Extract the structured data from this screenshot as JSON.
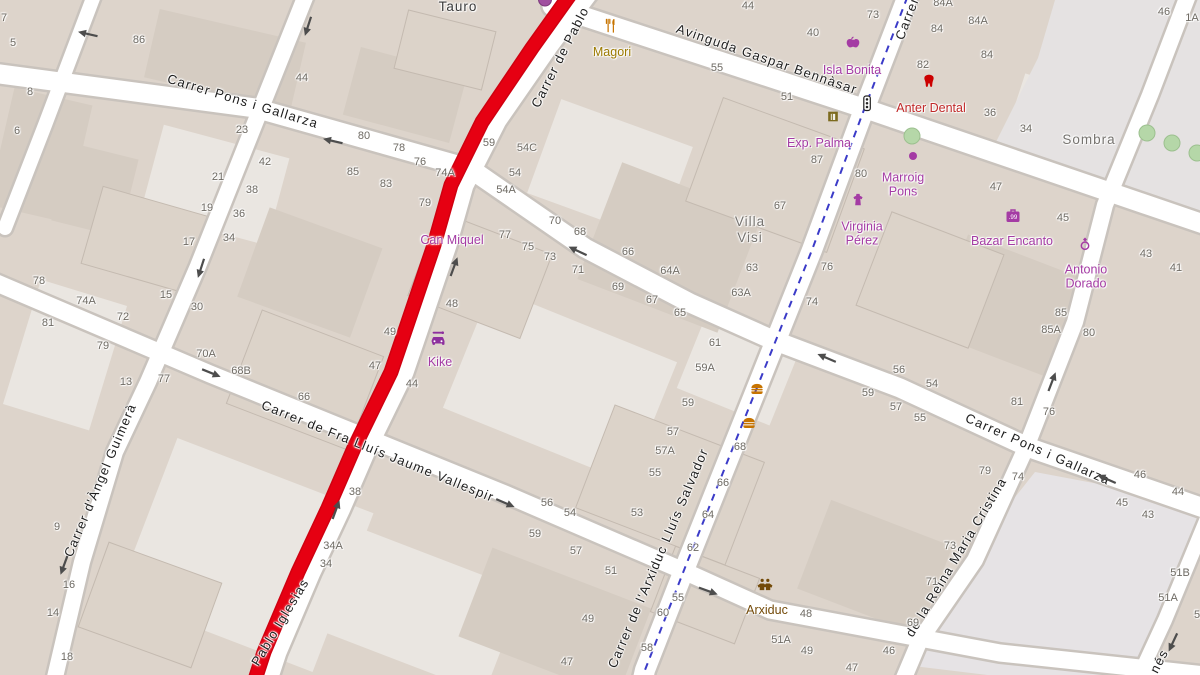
{
  "map": {
    "colors": {
      "building": "#ddd4cb",
      "street_fill": "#ffffff",
      "street_casing": "#c9c3bd",
      "route_red": "#e60012",
      "cycleway_blue": "#3b3bc8",
      "shop_magenta": "#a43ba4",
      "food_amber": "#9c7a00",
      "health_red": "#c02828",
      "community_brown": "#734a08",
      "number_gray": "#6e6a63",
      "plaza_gray": "#e5e2e2"
    },
    "street_labels": [
      {
        "text": "Carrer Pons i Gallarza",
        "x": 243,
        "y": 101,
        "rot": 17
      },
      {
        "text": "Carrer Pons i Gallarza",
        "x": 1038,
        "y": 449,
        "rot": 24
      },
      {
        "text": "Avinguda Gaspar Bennàsar",
        "x": 767,
        "y": 59,
        "rot": 19
      },
      {
        "text": "Carrer de Pablo",
        "x": 560,
        "y": 57,
        "rot": -63
      },
      {
        "text": "Pablo Iglesias",
        "x": 280,
        "y": 622,
        "rot": -59
      },
      {
        "text": "Carrer d'Àngel Guimerà",
        "x": 100,
        "y": 480,
        "rot": -67
      },
      {
        "text": "Carrer de Fra Lluís Jaume Vallespir",
        "x": 378,
        "y": 451,
        "rot": 22
      },
      {
        "text": "Carrer de l'Arxiduc Lluís Salvador",
        "x": 658,
        "y": 558,
        "rot": -67
      },
      {
        "text": "de la Reina Maria Cristina",
        "x": 956,
        "y": 557,
        "rot": -59
      },
      {
        "text": "Carrer de",
        "x": 911,
        "y": 8,
        "rot": -69
      },
      {
        "text": "nés",
        "x": 1159,
        "y": 661,
        "rot": -63
      }
    ],
    "place_labels": [
      {
        "lines": [
          "Tauro"
        ],
        "x": 458,
        "y": 7,
        "color": "#3a3a3a"
      },
      {
        "lines": [
          "Villa",
          "Visi"
        ],
        "x": 750,
        "y": 230,
        "color": "#76736f"
      },
      {
        "lines": [
          "Sombra"
        ],
        "x": 1089,
        "y": 140,
        "color": "#76736f"
      }
    ],
    "pois": [
      {
        "lines": [
          "Magori"
        ],
        "icon": "restaurant-icon",
        "ix": 610,
        "iy": 28,
        "lx": 612,
        "ly": 52,
        "color": "#9c7a00"
      },
      {
        "lines": [
          "Isla Bonita"
        ],
        "icon": "greengrocer-icon",
        "ix": 853,
        "iy": 45,
        "lx": 852,
        "ly": 70,
        "color": "#a43ba4"
      },
      {
        "lines": [
          "Anter Dental"
        ],
        "icon": "tooth-icon",
        "ix": 929,
        "iy": 84,
        "lx": 931,
        "ly": 108,
        "color": "#c02828"
      },
      {
        "lines": [
          "Exp. Palma"
        ],
        "icon": "gallery-icon",
        "ix": 833,
        "iy": 119,
        "lx": 819,
        "ly": 143,
        "color": "#a43ba4"
      },
      {
        "lines": [
          "Marroig",
          "Pons"
        ],
        "icon": "shop-dot-icon",
        "ix": 913,
        "iy": 157,
        "lx": 903,
        "ly": 185,
        "color": "#a43ba4"
      },
      {
        "lines": [
          "Virginia",
          "Pérez"
        ],
        "icon": "clothes-icon",
        "ix": 858,
        "iy": 202,
        "lx": 862,
        "ly": 234,
        "color": "#a43ba4"
      },
      {
        "lines": [
          "Bazar Encanto"
        ],
        "icon": "variety-store-icon",
        "ix": 1013,
        "iy": 218,
        "lx": 1012,
        "ly": 241,
        "color": "#a43ba4"
      },
      {
        "lines": [
          "Antonio",
          "Dorado"
        ],
        "icon": "jewelry-ring-icon",
        "ix": 1085,
        "iy": 246,
        "lx": 1086,
        "ly": 277,
        "color": "#a43ba4"
      },
      {
        "lines": [
          "Can Miquel"
        ],
        "icon": null,
        "lx": 452,
        "ly": 240,
        "color": "#a43ba4"
      },
      {
        "lines": [
          "Kike"
        ],
        "icon": "car-repair-icon",
        "ix": 438,
        "iy": 340,
        "lx": 440,
        "ly": 362,
        "color": "#a43ba4"
      },
      {
        "lines": [],
        "icon": "fast-food-icon",
        "ix": 757,
        "iy": 391,
        "color": "#c77400"
      },
      {
        "lines": [],
        "icon": "fast-food-icon",
        "ix": 749,
        "iy": 425,
        "color": "#c77400"
      },
      {
        "lines": [
          "Arxiduc"
        ],
        "icon": "community-icon",
        "ix": 765,
        "iy": 587,
        "lx": 767,
        "ly": 610,
        "color": "#734a08"
      },
      {
        "lines": [],
        "icon": "traffic-signals-icon",
        "ix": 867,
        "iy": 106,
        "color": "#222222"
      },
      {
        "lines": [],
        "icon": "shop-circle-icon",
        "ix": 545,
        "iy": 2,
        "color": "#a04fa0"
      }
    ],
    "house_numbers": [
      [
        "86",
        139,
        40
      ],
      [
        "7",
        4,
        18
      ],
      [
        "5",
        13,
        43
      ],
      [
        "8",
        30,
        92
      ],
      [
        "6",
        17,
        131
      ],
      [
        "44",
        302,
        78
      ],
      [
        "23",
        242,
        130
      ],
      [
        "42",
        265,
        162
      ],
      [
        "21",
        218,
        177
      ],
      [
        "38",
        252,
        190
      ],
      [
        "80",
        364,
        136
      ],
      [
        "85",
        353,
        172
      ],
      [
        "83",
        386,
        184
      ],
      [
        "78",
        399,
        148
      ],
      [
        "76",
        420,
        162
      ],
      [
        "74A",
        445,
        173
      ],
      [
        "59",
        489,
        143
      ],
      [
        "54C",
        527,
        148
      ],
      [
        "54",
        515,
        173
      ],
      [
        "54A",
        506,
        190
      ],
      [
        "44",
        748,
        6
      ],
      [
        "55",
        717,
        68
      ],
      [
        "51",
        787,
        97
      ],
      [
        "73",
        873,
        15
      ],
      [
        "40",
        813,
        33
      ],
      [
        "84A",
        943,
        3
      ],
      [
        "84A",
        978,
        21
      ],
      [
        "84",
        937,
        29
      ],
      [
        "84",
        987,
        55
      ],
      [
        "82",
        923,
        65
      ],
      [
        "36",
        990,
        113
      ],
      [
        "34",
        1026,
        129
      ],
      [
        "47",
        996,
        187
      ],
      [
        "87",
        817,
        160
      ],
      [
        "80",
        861,
        174
      ],
      [
        "46",
        1164,
        12
      ],
      [
        "1A",
        1192,
        18
      ],
      [
        "19",
        207,
        208
      ],
      [
        "36",
        239,
        214
      ],
      [
        "17",
        189,
        242
      ],
      [
        "34",
        229,
        238
      ],
      [
        "15",
        166,
        295
      ],
      [
        "30",
        197,
        307
      ],
      [
        "13",
        126,
        382
      ],
      [
        "77",
        164,
        379
      ],
      [
        "78",
        39,
        281
      ],
      [
        "74A",
        86,
        301
      ],
      [
        "72",
        123,
        317
      ],
      [
        "81",
        48,
        323
      ],
      [
        "79",
        103,
        346
      ],
      [
        "70A",
        206,
        354
      ],
      [
        "68B",
        241,
        371
      ],
      [
        "66",
        304,
        397
      ],
      [
        "79",
        425,
        203
      ],
      [
        "77",
        505,
        235
      ],
      [
        "75",
        528,
        247
      ],
      [
        "73",
        550,
        257
      ],
      [
        "71",
        578,
        270
      ],
      [
        "69",
        618,
        287
      ],
      [
        "67",
        652,
        300
      ],
      [
        "65",
        680,
        313
      ],
      [
        "70",
        555,
        221
      ],
      [
        "68",
        580,
        232
      ],
      [
        "66",
        628,
        252
      ],
      [
        "64A",
        670,
        271
      ],
      [
        "63",
        752,
        268
      ],
      [
        "63A",
        741,
        293
      ],
      [
        "67",
        780,
        206
      ],
      [
        "61",
        715,
        343
      ],
      [
        "59A",
        705,
        368
      ],
      [
        "59",
        688,
        403
      ],
      [
        "57",
        673,
        432
      ],
      [
        "48",
        452,
        304
      ],
      [
        "49",
        390,
        332
      ],
      [
        "47",
        375,
        366
      ],
      [
        "44",
        412,
        384
      ],
      [
        "38",
        355,
        492
      ],
      [
        "34A",
        333,
        546
      ],
      [
        "34",
        326,
        564
      ],
      [
        "9",
        57,
        527
      ],
      [
        "16",
        69,
        585
      ],
      [
        "14",
        53,
        613
      ],
      [
        "18",
        67,
        657
      ],
      [
        "56",
        547,
        503
      ],
      [
        "54",
        570,
        513
      ],
      [
        "53",
        637,
        513
      ],
      [
        "59",
        535,
        534
      ],
      [
        "57",
        576,
        551
      ],
      [
        "51",
        611,
        571
      ],
      [
        "49",
        588,
        619
      ],
      [
        "47",
        567,
        662
      ],
      [
        "57A",
        665,
        451
      ],
      [
        "55",
        655,
        473
      ],
      [
        "68",
        740,
        447
      ],
      [
        "66",
        723,
        483
      ],
      [
        "64",
        708,
        515
      ],
      [
        "62",
        693,
        548
      ],
      [
        "55",
        678,
        598
      ],
      [
        "60",
        663,
        613
      ],
      [
        "58",
        647,
        648
      ],
      [
        "48",
        806,
        614
      ],
      [
        "51A",
        781,
        640
      ],
      [
        "49",
        807,
        651
      ],
      [
        "47",
        852,
        668
      ],
      [
        "79",
        985,
        471
      ],
      [
        "74",
        1018,
        477
      ],
      [
        "73",
        950,
        546
      ],
      [
        "71",
        932,
        582
      ],
      [
        "69",
        913,
        623
      ],
      [
        "46",
        889,
        651
      ],
      [
        "46",
        1140,
        475
      ],
      [
        "44",
        1178,
        492
      ],
      [
        "45",
        1122,
        503
      ],
      [
        "43",
        1148,
        515
      ],
      [
        "51B",
        1180,
        573
      ],
      [
        "51A",
        1168,
        598
      ],
      [
        "5",
        1197,
        615
      ],
      [
        "45",
        1063,
        218
      ],
      [
        "43",
        1146,
        254
      ],
      [
        "41",
        1176,
        268
      ],
      [
        "85",
        1061,
        313
      ],
      [
        "85A",
        1051,
        330
      ],
      [
        "80",
        1089,
        333
      ],
      [
        "81",
        1017,
        402
      ],
      [
        "76",
        1049,
        412
      ],
      [
        "56",
        899,
        370
      ],
      [
        "54",
        932,
        384
      ],
      [
        "59",
        868,
        393
      ],
      [
        "57",
        896,
        407
      ],
      [
        "55",
        920,
        418
      ],
      [
        "76",
        827,
        267
      ],
      [
        "74",
        812,
        302
      ]
    ],
    "oneway_arrows": [
      {
        "x": 88,
        "y": 33,
        "a": 193
      },
      {
        "x": 307,
        "y": 26,
        "a": 108
      },
      {
        "x": 333,
        "y": 140,
        "a": 193
      },
      {
        "x": 200,
        "y": 268,
        "a": 108
      },
      {
        "x": 455,
        "y": 267,
        "a": -70
      },
      {
        "x": 578,
        "y": 250,
        "a": 205
      },
      {
        "x": 211,
        "y": 374,
        "a": 22
      },
      {
        "x": 63,
        "y": 565,
        "a": 110
      },
      {
        "x": 337,
        "y": 510,
        "a": -70
      },
      {
        "x": 505,
        "y": 504,
        "a": 23
      },
      {
        "x": 708,
        "y": 592,
        "a": 20
      },
      {
        "x": 827,
        "y": 357,
        "a": 203
      },
      {
        "x": 1053,
        "y": 382,
        "a": -69
      },
      {
        "x": 1107,
        "y": 478,
        "a": 204
      },
      {
        "x": 1172,
        "y": 642,
        "a": 115
      }
    ],
    "trees": [
      {
        "x": 912,
        "y": 136
      },
      {
        "x": 1147,
        "y": 133
      },
      {
        "x": 1172,
        "y": 143
      },
      {
        "x": 1197,
        "y": 153
      }
    ]
  }
}
